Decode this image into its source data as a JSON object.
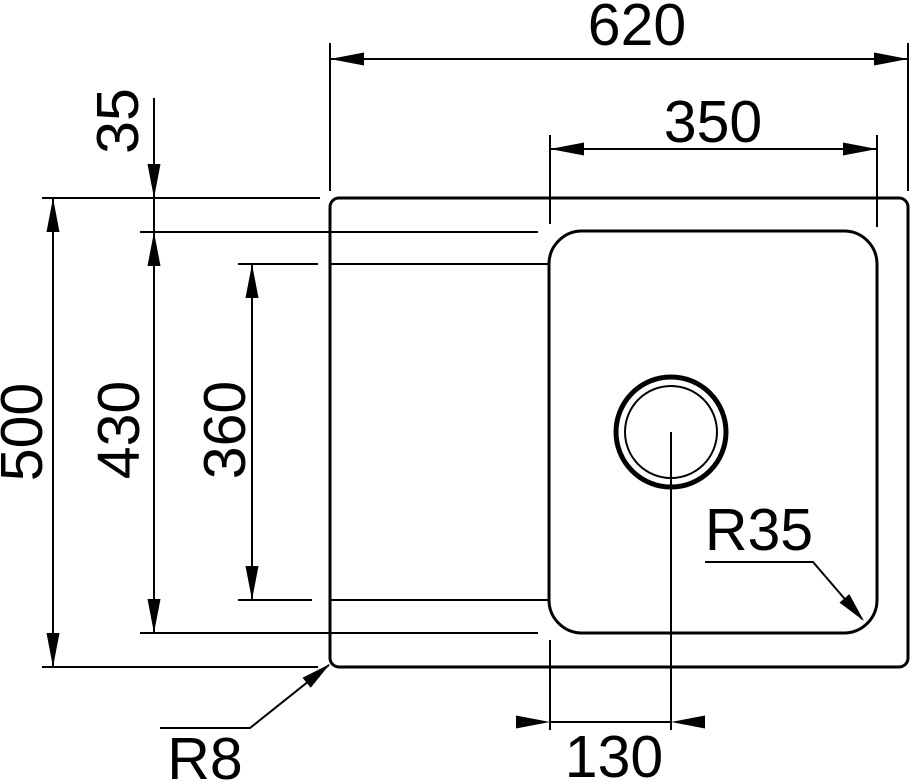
{
  "diagram": {
    "background_color": "#ffffff",
    "line_color": "#000000",
    "labels": {
      "overall_width": "620",
      "bowl_width": "350",
      "rim_to_bowl_offset": "35",
      "overall_depth": "500",
      "bowl_depth": "430",
      "recess_depth": "360",
      "drain_offset": "130",
      "rim_corner_radius": "R8",
      "bowl_corner_radius": "R35"
    }
  }
}
